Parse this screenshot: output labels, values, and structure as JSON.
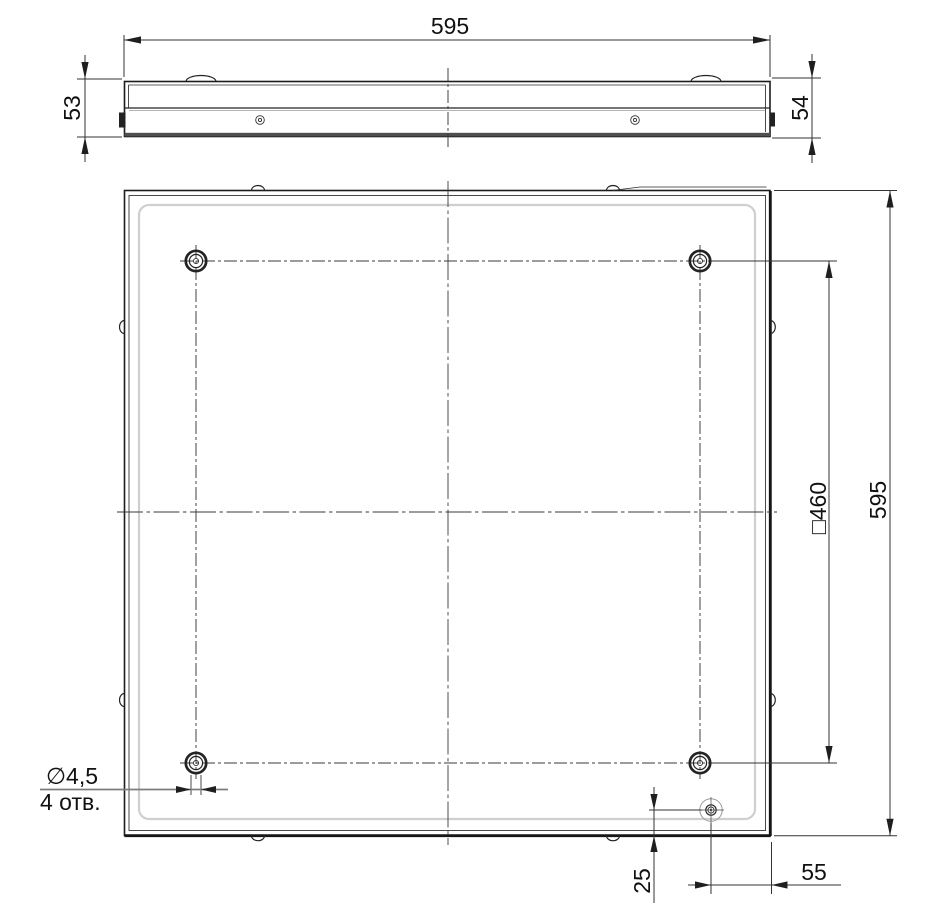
{
  "page": {
    "background_color": "#ffffff",
    "line_color": "#222222",
    "accent_gray": "#cfcfcf"
  },
  "views": {
    "side_view": {
      "dim_width": "595",
      "dim_height_left": "53",
      "dim_height_right": "54"
    },
    "plan_view": {
      "dim_height": "595",
      "dim_mount_square": "□460",
      "dim_hole_offset_bottom": "25",
      "dim_hole_offset_right": "55",
      "hole_callout_diameter": "∅4,5",
      "hole_callout_count": "4 отв."
    }
  }
}
